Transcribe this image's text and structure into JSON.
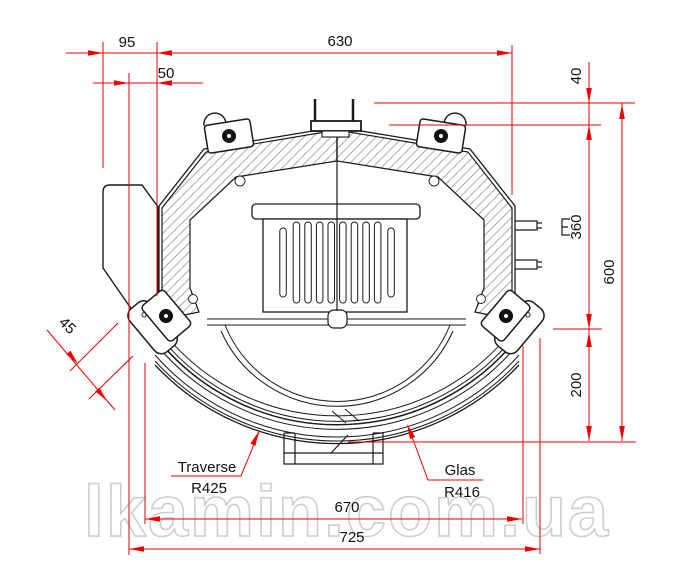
{
  "drawing": {
    "type": "technical-drawing-top-view",
    "subject": "fireplace insert / stove cross-section seen from above"
  },
  "colors": {
    "dimension_red": "#ee0000",
    "line_black": "#1a1a1a",
    "hatch_gray": "#adadad",
    "watermark_gray": "#c9c9c9"
  },
  "dims": {
    "d95": "95",
    "d50": "50",
    "d630": "630",
    "d40": "40",
    "d360": "360",
    "d600": "600",
    "d200": "200",
    "d45": "45",
    "d670": "670",
    "d725": "725"
  },
  "labels": {
    "traverse": "Traverse",
    "traverse_radius": "R425",
    "glas": "Glas",
    "glas_radius": "R416"
  },
  "watermark": "lkamin.com.ua"
}
